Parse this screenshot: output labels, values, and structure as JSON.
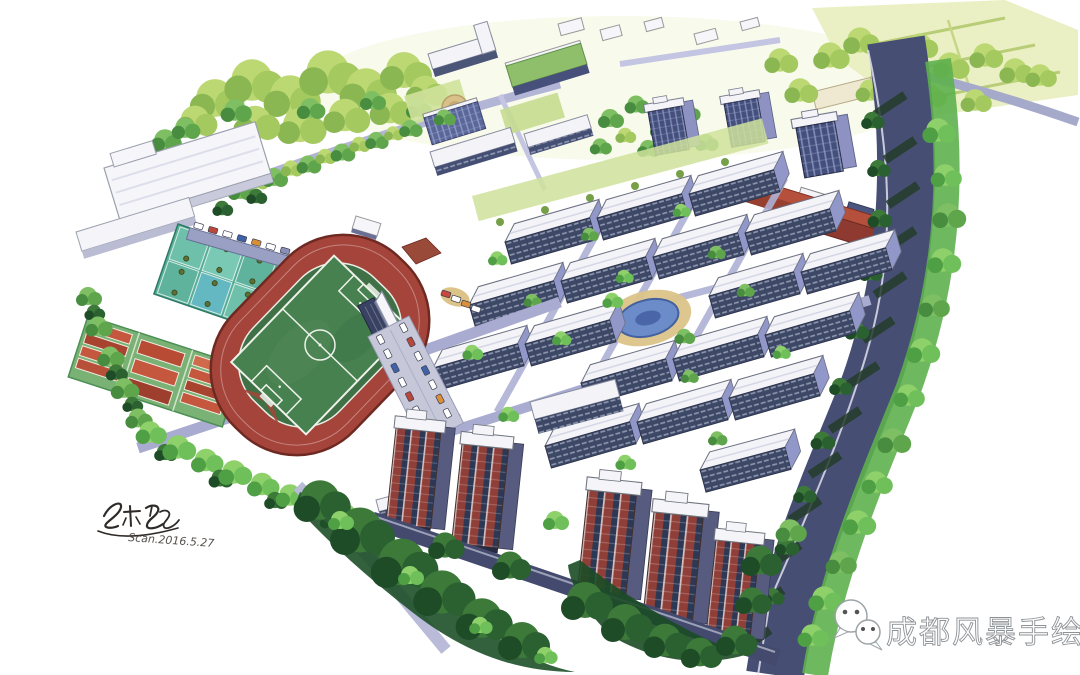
{
  "artwork": {
    "kind": "hand-drawn marker aerial rendering",
    "subject": "campus sports grounds, office park and residential towers master plan"
  },
  "watermark": {
    "text": "成都风暴手绘",
    "icon": "wechat-icon"
  },
  "signature": {
    "date": "Scan.2016.5.27"
  },
  "palette": {
    "background": "#ffffff",
    "track_red": "#a5443a",
    "field_green": "#47814f",
    "court_teal": "#5fb39c",
    "tennis_orange": "#c4573d",
    "tennis_green": "#79b274",
    "roof_white": "#f3f3f8",
    "facade_navy": "#3d4867",
    "side_lavender": "#9297c9",
    "brick_red": "#8f3f37",
    "road_lavender": "#a9abd0",
    "avenue_slate": "#474e74",
    "tree_green": "#5ea54c",
    "tree_dark": "#1e4c27",
    "tree_yellow_green": "#bcd873",
    "lawn_pale": "#cfe29b",
    "field_pale_yellow": "#e9efc0",
    "pond_blue": "#6b8cc9",
    "plaza_tan": "#dcc489"
  }
}
